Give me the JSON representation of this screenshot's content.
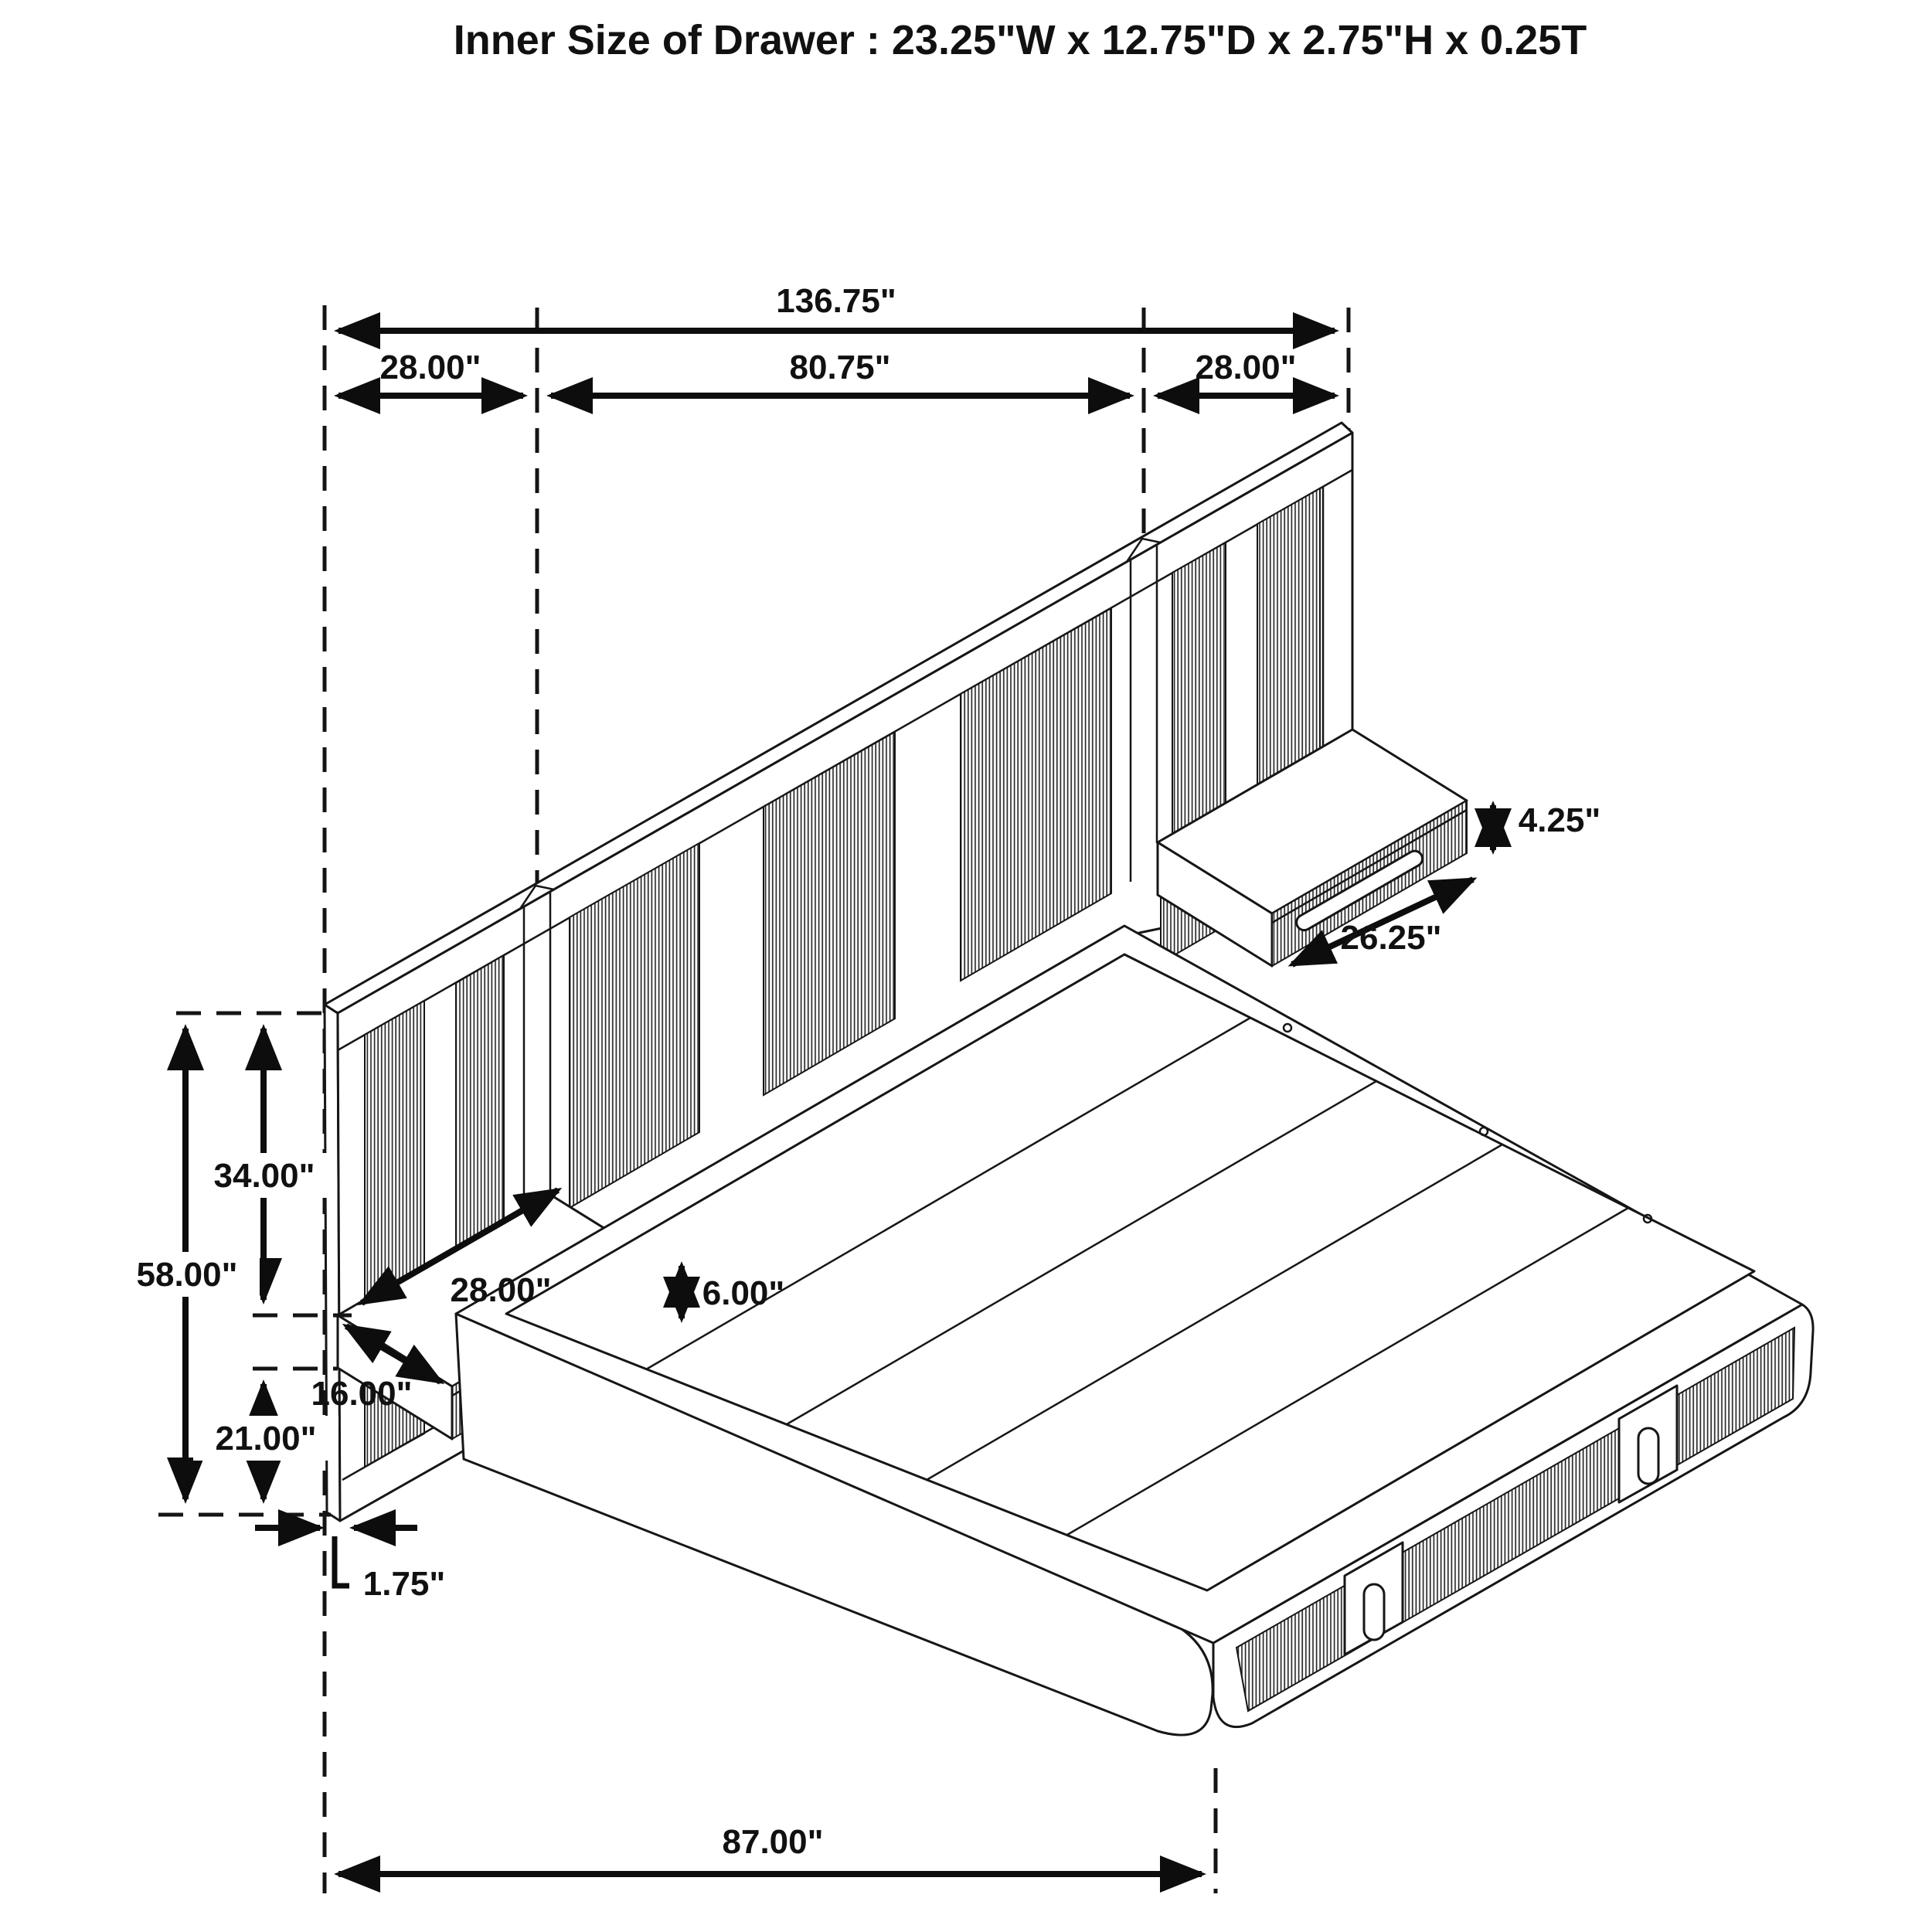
{
  "title": "Inner Size of Drawer : 23.25\"W x 12.75\"D x 2.75\"H x 0.25T",
  "dims": {
    "overall_width": "136.75\"",
    "left_section_width": "28.00\"",
    "center_section_width": "80.75\"",
    "right_section_width": "28.00\"",
    "upper_headboard_height": "34.00\"",
    "total_headboard_height": "58.00\"",
    "lower_clearance_height": "21.00\"",
    "nightstand_depth": "16.00\"",
    "nightstand_width": "28.00\"",
    "nightstand_front_height": "6.00\"",
    "panel_thickness": "1.75\"",
    "bed_length": "87.00\"",
    "right_nightstand_height": "4.25\"",
    "right_nightstand_drawer_width": "26.25\""
  }
}
